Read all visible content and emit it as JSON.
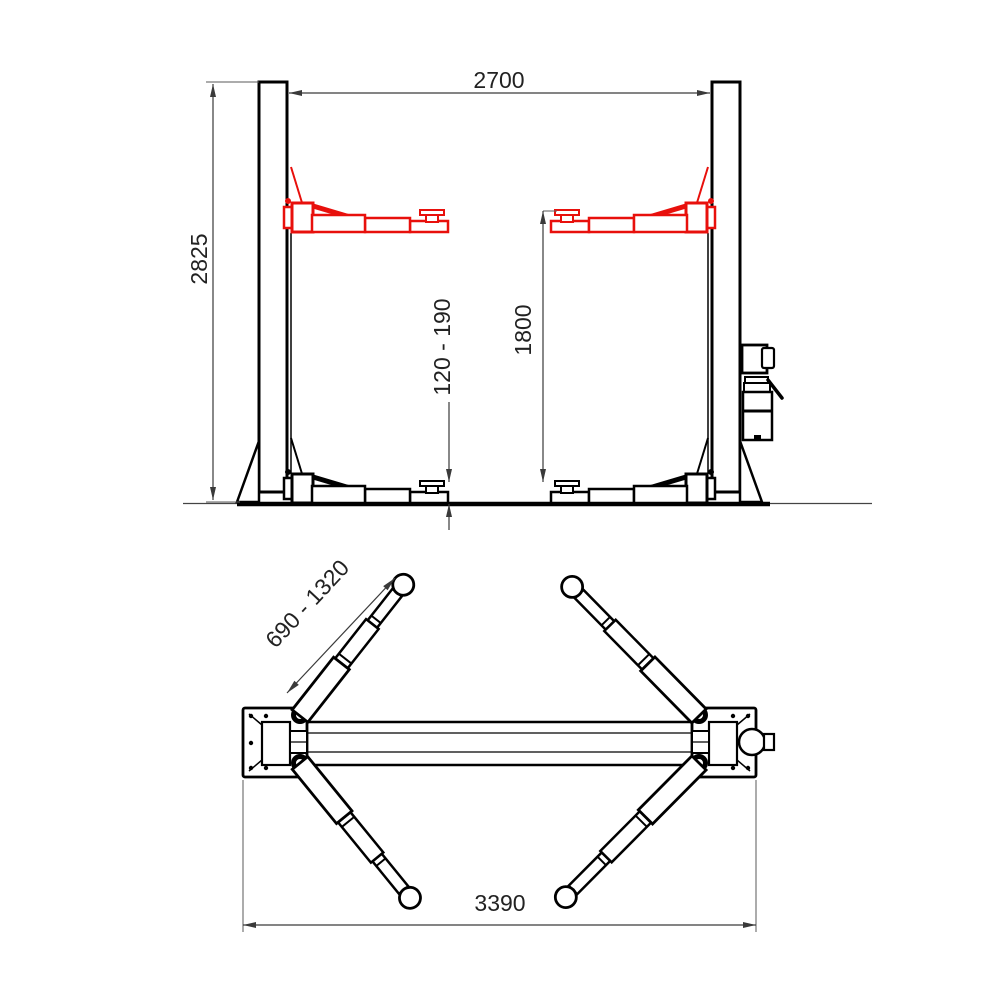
{
  "front_view": {
    "dim_width_between_posts": "2700",
    "dim_overall_height": "2825",
    "dim_pad_height_range": "120 - 190",
    "dim_max_lifting_height": "1800"
  },
  "plan_view": {
    "dim_arm_reach_range": "690 - 1320",
    "dim_overall_width": "3390"
  },
  "colors": {
    "outline": "#000000",
    "raised_arm_accent": "#e8100c",
    "dimension_line": "#3a3a3a"
  }
}
